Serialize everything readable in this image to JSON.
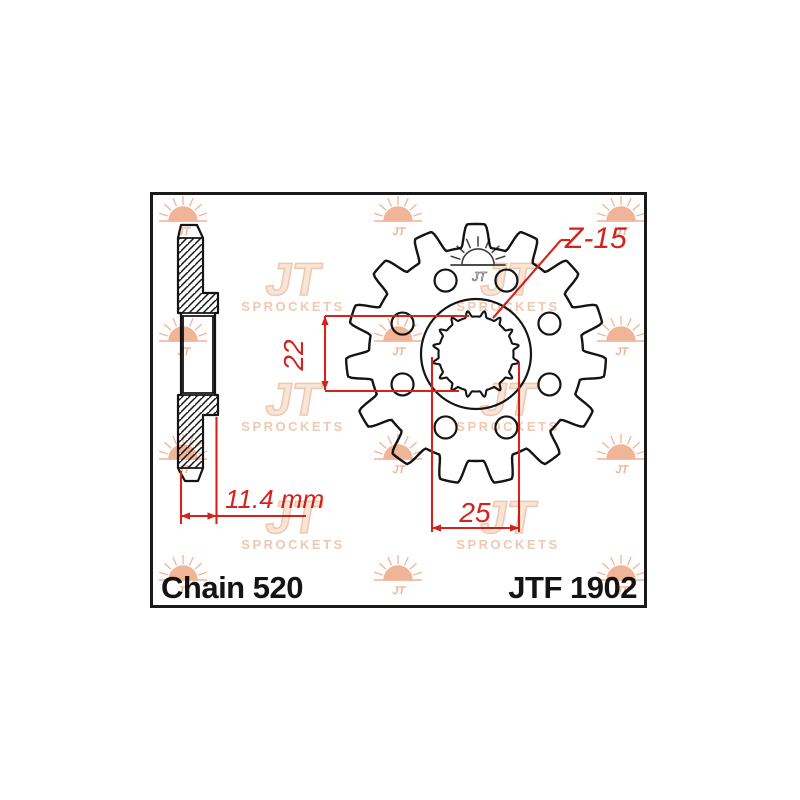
{
  "frame": {
    "x": 150,
    "y": 192,
    "width": 491,
    "height": 410,
    "border_color": "#1a1a1a",
    "background": "#ffffff"
  },
  "title_labels": {
    "chain": "Chain 520",
    "part_number": "JTF 1902",
    "text_color": "#141414"
  },
  "dimensions": {
    "color": "#d3231c",
    "bore_inner": {
      "text": "22"
    },
    "bore_outer": {
      "text": "25"
    },
    "hub_width": {
      "text": "11.4 mm"
    },
    "tooth_count": {
      "text": "Z-15"
    }
  },
  "watermark": {
    "sun_color": "#f0b498",
    "logo_color": "#eec9b2",
    "logo_fill": "#f7e5d8",
    "dark_color": "#3f3f3f",
    "jt_text": "JT",
    "sprockets_text": "SPROCKETS",
    "sun_columns_x": [
      30,
      245,
      468
    ],
    "sun_rows_y": [
      26,
      146,
      264,
      385
    ],
    "logo_columns_x": [
      140,
      355
    ],
    "logo_rows_y": [
      88,
      208,
      326
    ],
    "dark_sun": {
      "x": 325,
      "y": 70
    }
  },
  "drawing": {
    "line_color": "#141414",
    "gear": {
      "cx": 323,
      "cy": 159,
      "teeth": 15,
      "tip_r": 130,
      "root_r": 107,
      "hub_r": 55,
      "holes": {
        "count": 8,
        "ring_r": 79.5,
        "r": 11,
        "offset_deg": 22.5
      },
      "spline": {
        "teeth": 16,
        "inner_r": 37.5,
        "outer_r": 43.5
      }
    },
    "side_view": {
      "outline": "M28,30 L44,30 L50,43 L50,98 L65,98 L65,118 L62,118 L62,200 L65,200 L65,220 L50,220 L50,273 L45,286 L32,286 L25,273 L25,200 L28,200 L28,118 L25,118 L25,43 Z",
      "hatch_regions": [
        "M25,43 L50,43 L50,98 L65,98 L65,118 L25,118 Z",
        "M25,200 L65,200 L65,220 L50,220 L50,273 L25,273 Z"
      ],
      "lines": [
        [
          25,
          43,
          50,
          43
        ],
        [
          28,
          118,
          62,
          118
        ],
        [
          28,
          121,
          62,
          121
        ],
        [
          28,
          198,
          62,
          198
        ],
        [
          28,
          200,
          62,
          200
        ],
        [
          25,
          273,
          50,
          273
        ],
        [
          30,
          121,
          30,
          198
        ],
        [
          60,
          121,
          60,
          198
        ]
      ]
    },
    "dims": {
      "d22": {
        "vline": [
          172,
          121,
          172,
          195
        ],
        "ext": [
          [
            172,
            121,
            316,
            121
          ],
          [
            172,
            196,
            306,
            196
          ]
        ]
      },
      "d25": {
        "vlines": [
          [
            279,
            162,
            279,
            337
          ],
          [
            366,
            168,
            366,
            337
          ]
        ],
        "hline": [
          279,
          333,
          366,
          333
        ]
      },
      "d114": {
        "ext": [
          [
            28,
            276,
            28,
            329
          ],
          [
            63.5,
            222,
            63.5,
            329
          ]
        ],
        "hline": [
          28,
          321,
          153,
          321
        ],
        "arrow_span": [
          28,
          63.5
        ]
      },
      "z15": {
        "leader": [
          340,
          123,
          408,
          45
        ],
        "tail": [
          408,
          45,
          417,
          45
        ]
      }
    }
  }
}
